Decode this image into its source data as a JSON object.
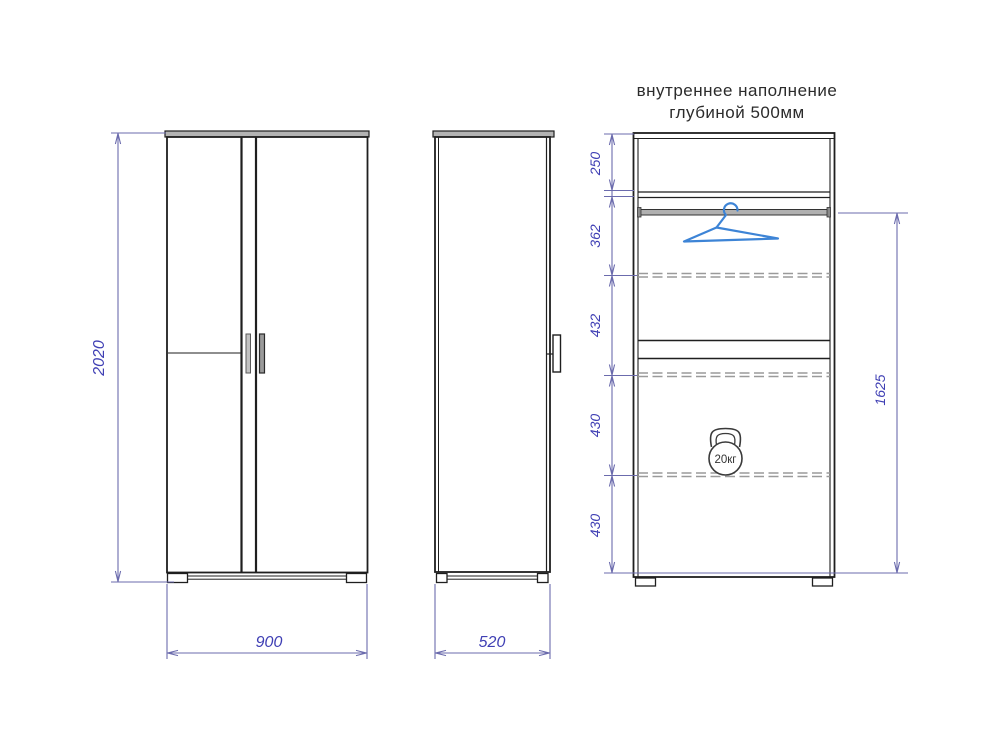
{
  "title": {
    "line1": "внутреннее наполнение",
    "line2": "глубиной 500мм"
  },
  "views": {
    "front": {
      "height": "2020",
      "width": "900"
    },
    "side": {
      "depth": "520"
    },
    "internal": {
      "sections": [
        "250",
        "362",
        "432",
        "430",
        "430"
      ],
      "hanging_zone_height": "1625",
      "max_load": "20кг",
      "icons": {
        "hanger": "clothes-hanger",
        "kettlebell": "kettlebell-weight"
      }
    }
  },
  "colors": {
    "outline": "#1f1f1f",
    "panel_gray": "#b3b3b3",
    "dashed_gray": "#9a9a9a",
    "dimension_line": "#6b6bad",
    "dimension_text": "#3f3fb4",
    "hanger_blue": "#3d84d6"
  }
}
